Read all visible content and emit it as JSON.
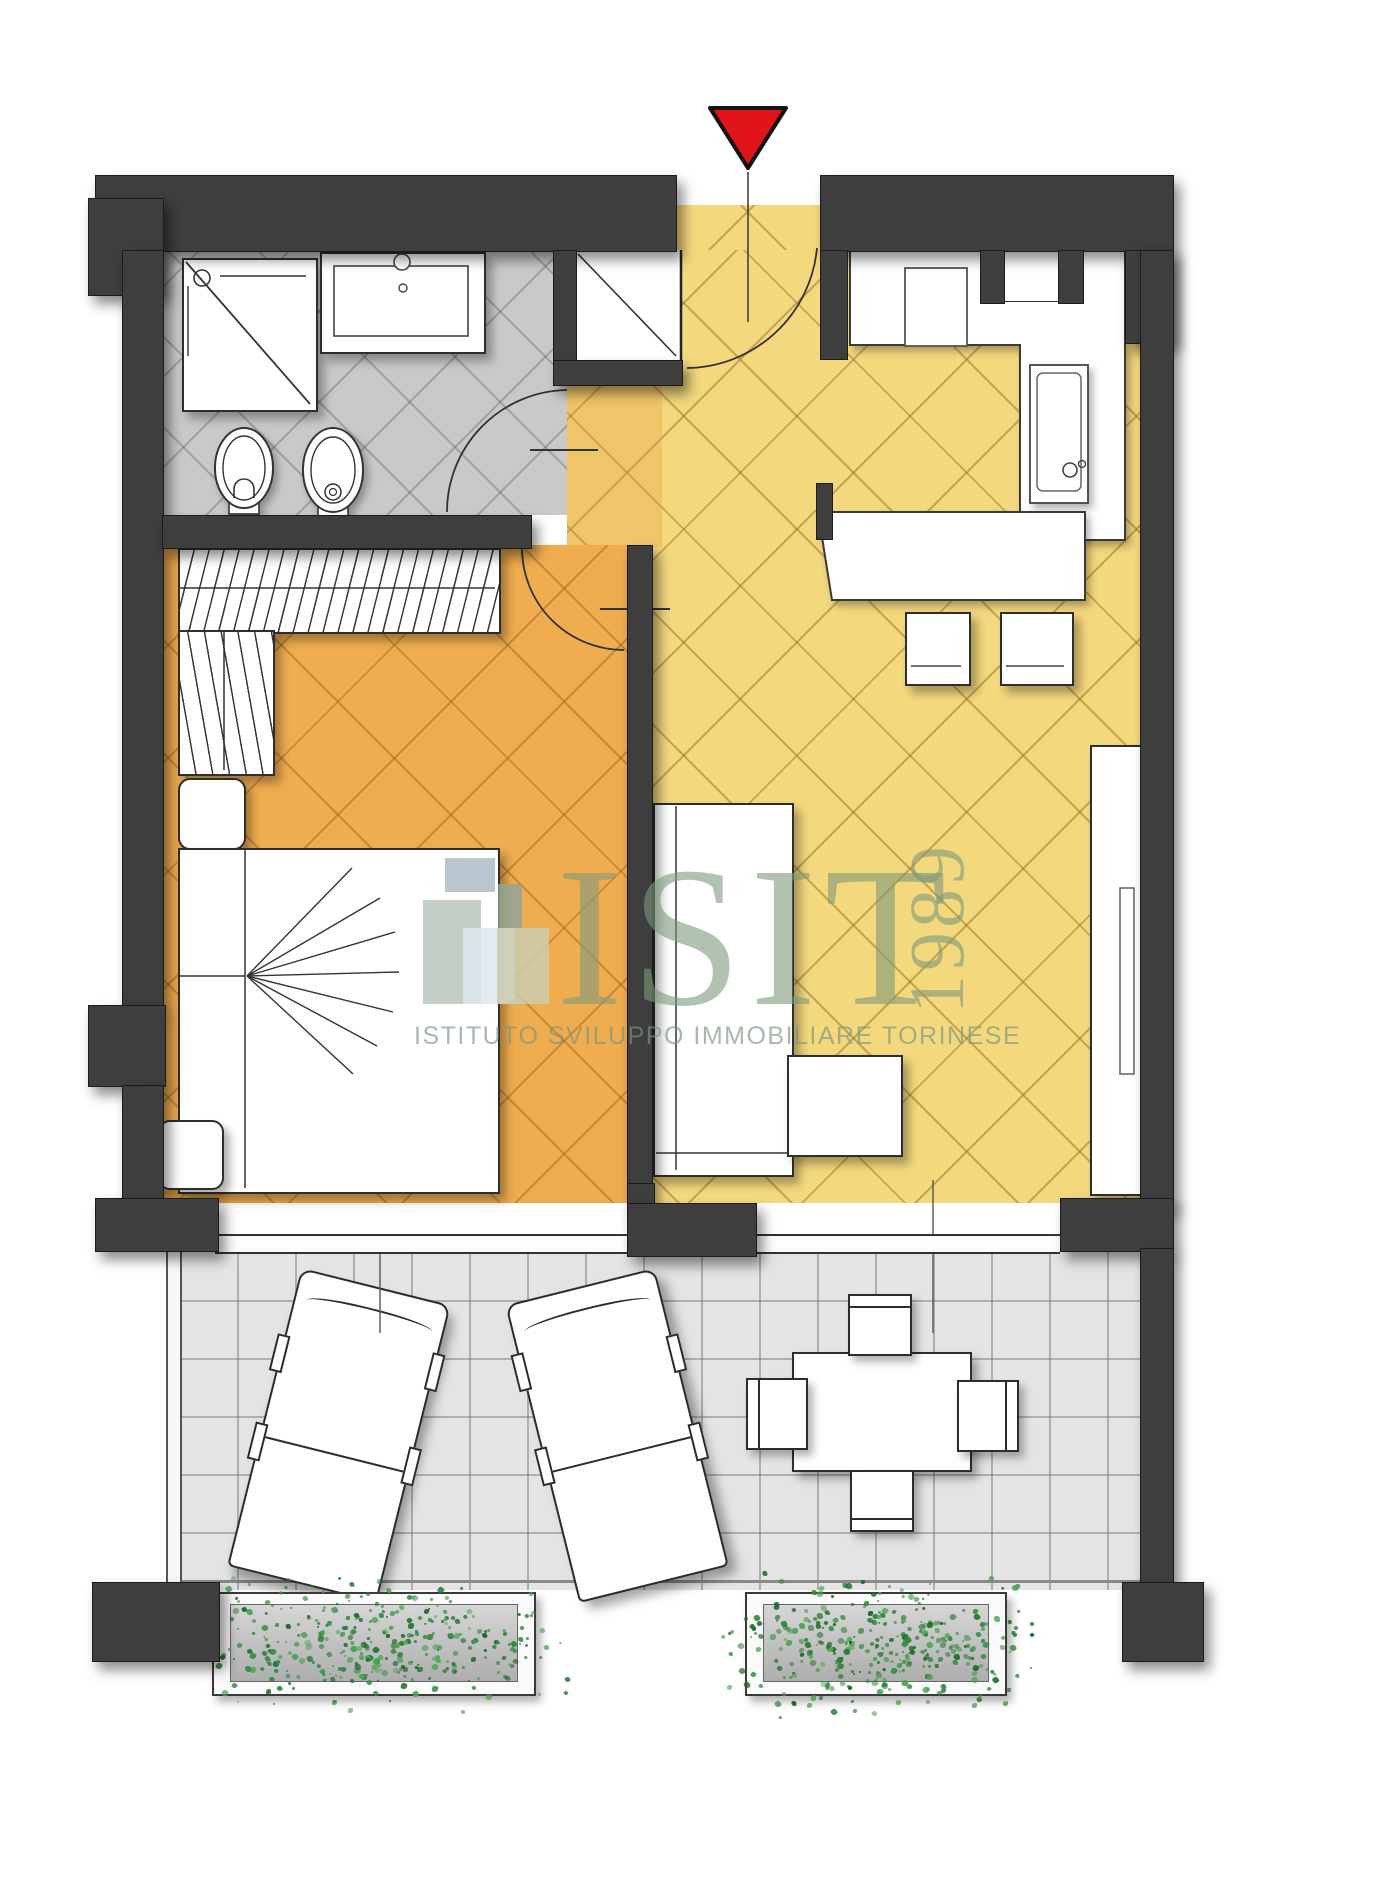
{
  "watermark": {
    "title": "ISIT",
    "year": "1989",
    "subtitle": "ISTITUTO SVILUPPO IMMOBILIARE TORINESE",
    "text_color": "#7e9a7d",
    "logo_colors": [
      "#a9b9c4",
      "#b7c3ba",
      "#8fa399",
      "#dde7ee",
      "#c9cdb2"
    ]
  },
  "entrance_marker": {
    "icon": "entrance-arrow-icon",
    "color": "#e01318"
  },
  "palette": {
    "wall": "#3e3e3e",
    "bathroom_floor": "#c9c9c9",
    "hall_floor": "#f3d87e",
    "bedroom_floor": "#f0ad4f",
    "terrace_floor": "#e4e4e4",
    "planter_green": "#2f8f3f"
  },
  "rooms": [
    {
      "id": "bathroom",
      "floor_color": "#c9c9c9"
    },
    {
      "id": "hall-kitchen-living",
      "floor_color": "#f3d87e"
    },
    {
      "id": "bedroom",
      "floor_color": "#f0ad4f"
    },
    {
      "id": "terrace",
      "floor_color": "#e4e4e4"
    }
  ],
  "planters": {
    "speckle_colors": [
      "#2f8f3f",
      "#257a33",
      "#4aa552",
      "#1e6b2b"
    ],
    "speckle_count": 340
  }
}
